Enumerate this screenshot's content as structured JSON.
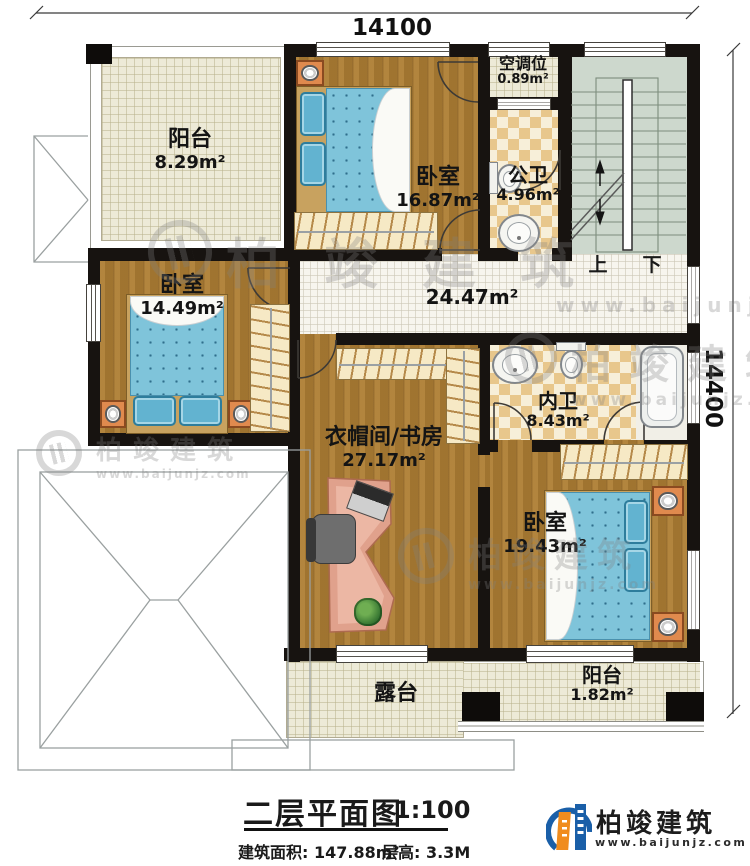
{
  "dimensions": {
    "top": "14100",
    "right": "14400"
  },
  "rooms": {
    "balcony_top": {
      "name": "阳台",
      "area": "8.29m²"
    },
    "bedroom_top": {
      "name": "卧室",
      "area": "16.87m²"
    },
    "ac_slot": {
      "name": "空调位",
      "area": "0.89m²"
    },
    "public_bath": {
      "name": "公卫",
      "area": "4.96m²"
    },
    "hallway": {
      "area": "24.47m²"
    },
    "bedroom_left": {
      "name": "卧室",
      "area": "14.49m²"
    },
    "ensuite_bath": {
      "name": "内卫",
      "area": "8.43m²"
    },
    "study": {
      "name": "衣帽间/书房",
      "area": "27.17m²"
    },
    "bedroom_right": {
      "name": "卧室",
      "area": "19.43m²"
    },
    "balcony_bottom": {
      "name": "阳台",
      "area": "1.82m²"
    },
    "terrace": {
      "name": "露台"
    }
  },
  "stairs": {
    "up_label": "上",
    "down_label": "下"
  },
  "title_block": {
    "title": "二层平面图",
    "scale": "1:100",
    "area": "建筑面积: 147.88m²",
    "floor_height": "层高: 3.3M"
  },
  "brand": {
    "name": "柏竣建筑",
    "website": "www.baijunjz.com"
  },
  "colors": {
    "wall": "#171310",
    "wood_floor": "#a87a33",
    "bath_tile": "#e8c78c",
    "balcony_floor": "#edead7",
    "stair_floor": "#cdd8cd",
    "bed": "#7fc4da",
    "brand_blue": "#1a5fa8",
    "brand_orange": "#f08c1e"
  }
}
